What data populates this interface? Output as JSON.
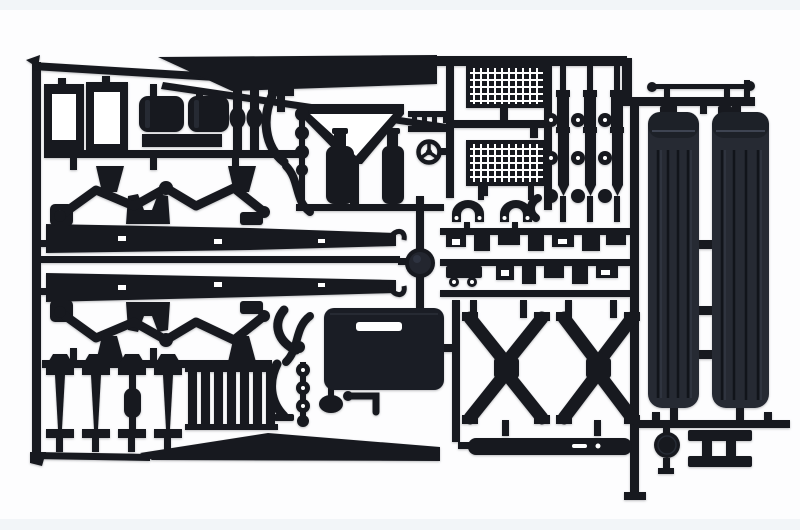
{
  "meta": {
    "alt": "Photograph of a black injection-moulded plastic model-kit sprue holding truck chassis parts on a plain white background"
  },
  "parts_depicted": [
    "chassis-side-rails",
    "suspension-linkage-arms",
    "cab-window-frames",
    "fuel-tank-halves",
    "radiator-grille-meshes",
    "shock-absorbers-and-wheels-discs",
    "steering-wheel",
    "air-bottles",
    "funnel-frame",
    "ribbed-canvas-side-panels",
    "steering-tie-rod",
    "cross-brace-x-members",
    "i-beam-crossmembers",
    "slat-parts",
    "large-fuel-tank",
    "exhaust-pipes",
    "front-bumper",
    "spare-wheel-disc",
    "ladder-frame-part"
  ],
  "colors": {
    "background": "#fdfdfe",
    "background_edge": "#edf1f5",
    "plastic": "#17191f",
    "plastic_soft": "#1a1d25",
    "plastic_sheen": "#262a33",
    "panel": "#262a33",
    "panel_band": "#1d2128",
    "panel_rib": "#11141a",
    "panel_highlight": "#4a5160",
    "hub_core": "#23262f",
    "hole": "#ffffff"
  }
}
